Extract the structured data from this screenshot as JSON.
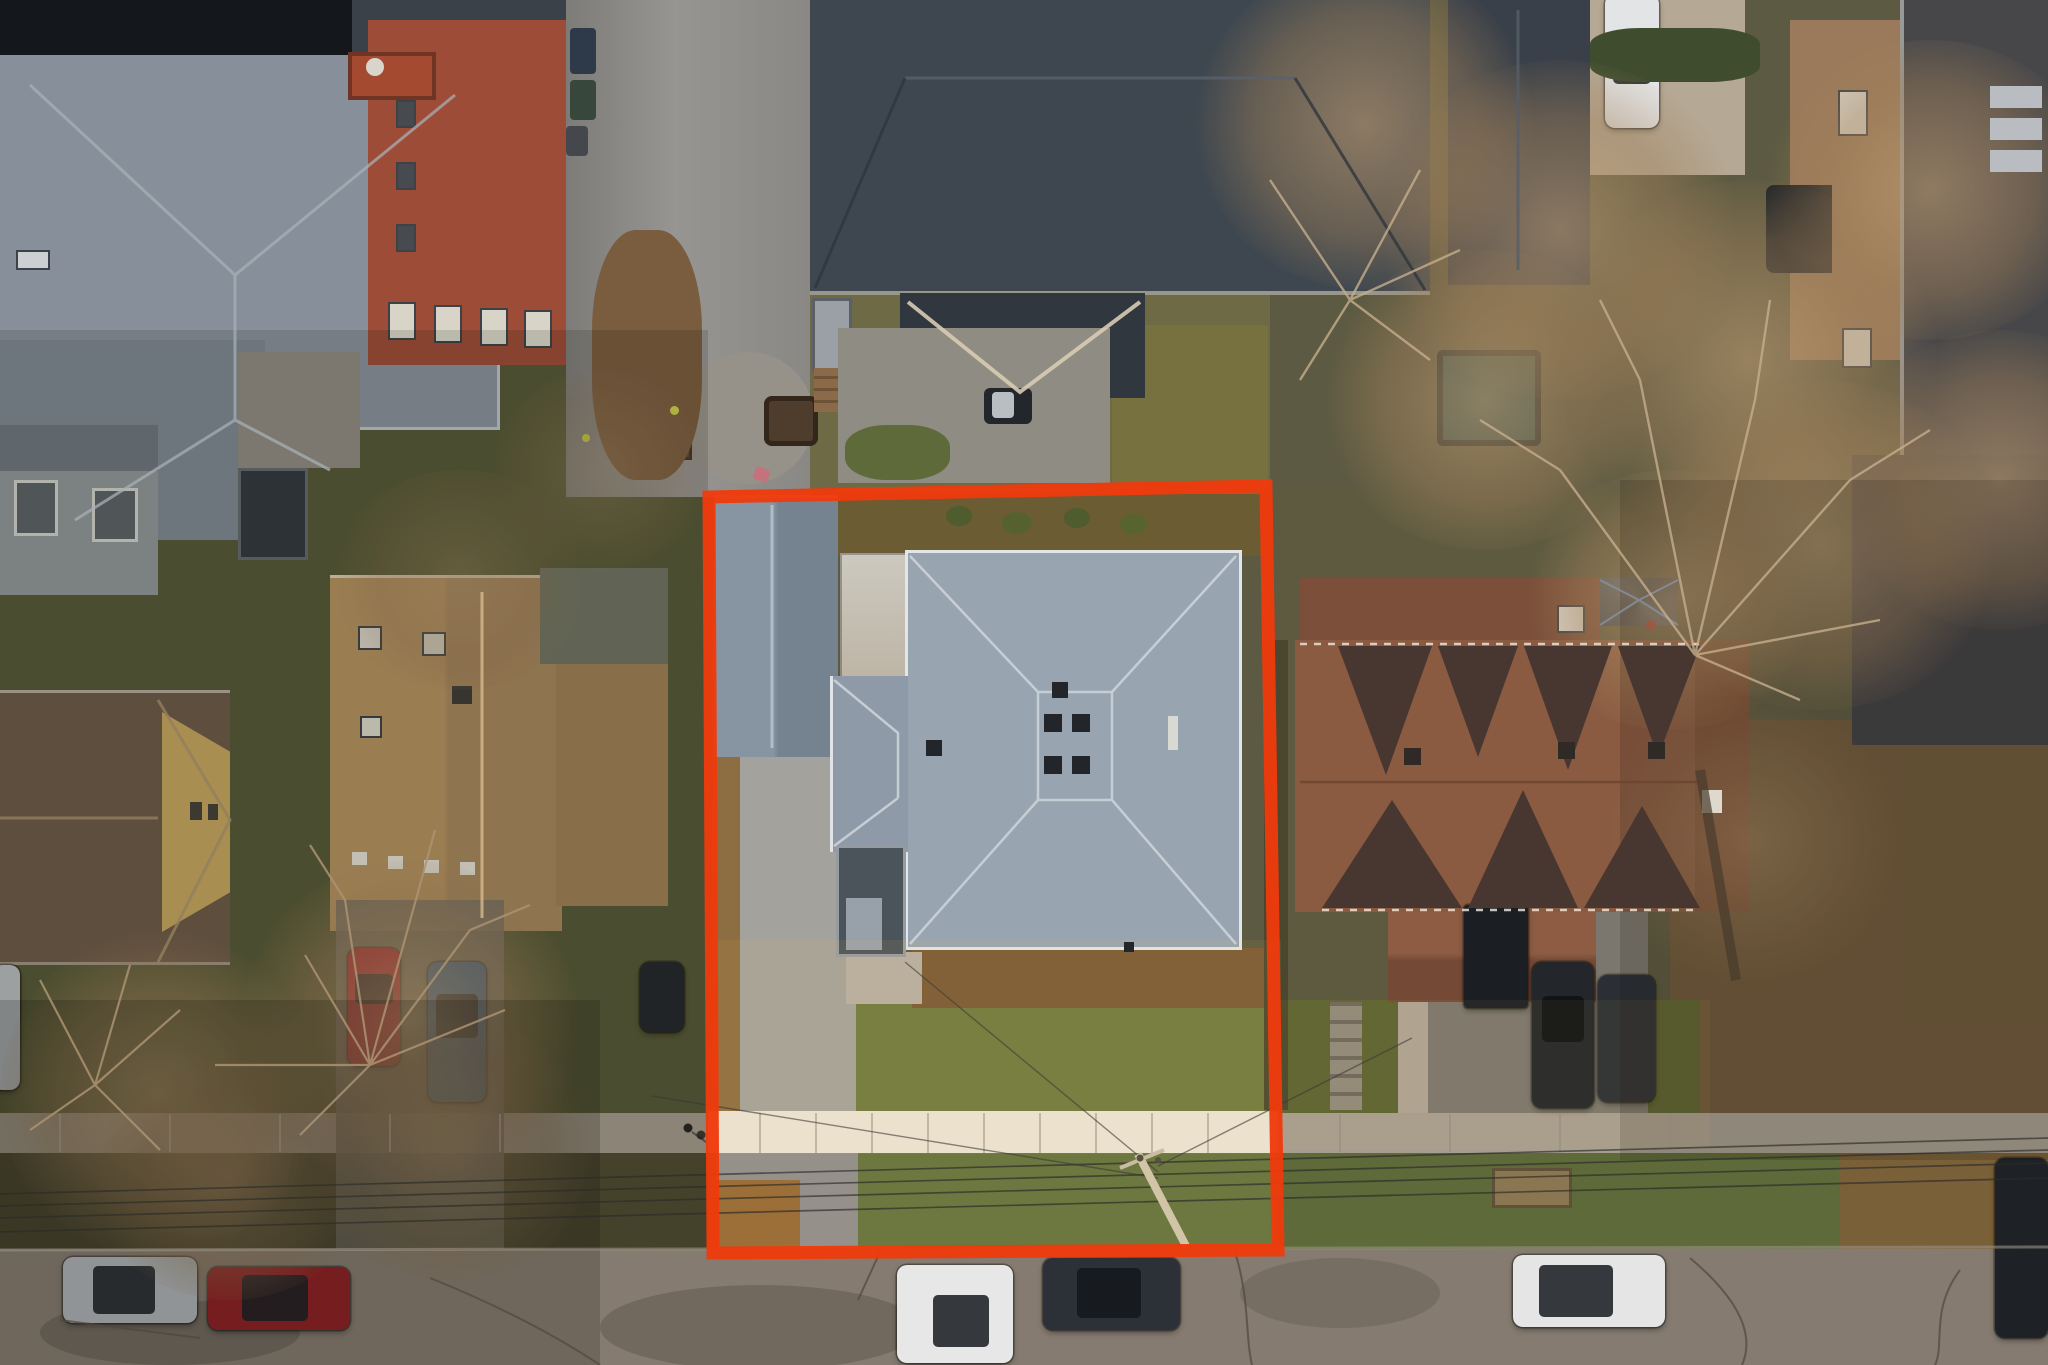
{
  "scene": {
    "type": "aerial-drone-photograph",
    "view": "top-down (nadir) view of a residential block",
    "season": "late-autumn, bare trees, fallen leaves",
    "lighting": "overcast dusk, muted tones, shadowed west side",
    "subject": "single lot highlighted by a rectangular property-boundary overlay",
    "annotation": {
      "shape": "slightly-skewed rectangle",
      "color": "#ee3a0c",
      "stroke_width_px": 13,
      "corners_px": [
        [
          709,
          497
        ],
        [
          1266,
          486
        ],
        [
          1278,
          1250
        ],
        [
          713,
          1253
        ]
      ]
    }
  },
  "palette": {
    "boundary_red": "#ee3a0c",
    "main_roof_gray": "#98a4b0",
    "garage_roof_gray": "#8795a3",
    "north_roof_dark": "#3e474f",
    "northwest_roof_gray": "#87909a",
    "brick_red": "#9c4c37",
    "tan_roof": "#b3905f",
    "yellow_siding": "#c2a45c",
    "brown_duplex_roof": "#8a5a41",
    "duplex_valley_dark": "#483730",
    "east_brick_tan": "#9a7a5a",
    "lawn_green": "#6e7a40",
    "dry_lawn_olive": "#565837",
    "street_asphalt": "#857b70",
    "sidewalk_bright": "#eae4d6",
    "sidewalk_dim": "#a69d90",
    "driveway_concrete": "#a4a29c",
    "tree_canopy_tan": "#b59677"
  },
  "objects": [
    {
      "name": "property-outline",
      "color": "#ee3a0c"
    },
    {
      "name": "lot-main-house-hip-roof",
      "color": "#98a4b0"
    },
    {
      "name": "lot-garage-roof",
      "color": "#8795a3"
    },
    {
      "name": "lot-concrete-pad",
      "color": "#ccc9c0"
    },
    {
      "name": "lot-dark-side-annex",
      "color": "#4b535b"
    },
    {
      "name": "lot-driveway",
      "color": "#a4a29c"
    },
    {
      "name": "lot-front-lawn",
      "color": "#6e7a40"
    },
    {
      "name": "lot-rear-garden-strip",
      "color": "#6b5c33"
    },
    {
      "name": "north-house-dark-roof",
      "color": "#3e474f"
    },
    {
      "name": "north-porch-roof",
      "color": "#30373e"
    },
    {
      "name": "alley-asphalt",
      "color": "#888682"
    },
    {
      "name": "rear-paver-patio",
      "color": "#8f8c84"
    },
    {
      "name": "fire-pit-chair",
      "color": "#4e3c2c"
    },
    {
      "name": "bbq-grill",
      "color": "#23272b"
    },
    {
      "name": "brick-rowhouse",
      "color": "#9c4c37"
    },
    {
      "name": "northwest-gray-roof",
      "color": "#87909a"
    },
    {
      "name": "northwest-flat-roof",
      "color": "#14171c"
    },
    {
      "name": "west-small-gray-house",
      "color": "#8e9697"
    },
    {
      "name": "west-storage-shed",
      "color": "#32383d"
    },
    {
      "name": "west-glass-pergola",
      "color": "#262b30"
    },
    {
      "name": "west-tan-house-roof",
      "color": "#b3905f"
    },
    {
      "name": "west-yellow-house",
      "color": "#c2a45c"
    },
    {
      "name": "west-overgrown-yard",
      "color": "#565837"
    },
    {
      "name": "east-brown-duplex-roof",
      "color": "#8a5a41"
    },
    {
      "name": "east-duplex-porch-roof",
      "color": "#744a36"
    },
    {
      "name": "east-gazebo-pyramid-roof",
      "color": "#4c5660"
    },
    {
      "name": "east-tan-brick-house",
      "color": "#9a7a5a"
    },
    {
      "name": "east-dark-roof-house",
      "color": "#474749"
    },
    {
      "name": "rear-dark-gable-house",
      "color": "#394049"
    },
    {
      "name": "teal-tarp-structure",
      "color": "#39544e"
    },
    {
      "name": "utility-pole",
      "color": "#d2c5a7"
    },
    {
      "name": "power-lines",
      "color": "#2b2b28"
    },
    {
      "name": "sidewalk-bright-segment",
      "color": "#eae4d6"
    },
    {
      "name": "sidewalk",
      "color": "#a69d90"
    },
    {
      "name": "street",
      "color": "#857b70"
    },
    {
      "name": "street-car-silver",
      "color": "#aeb3b6"
    },
    {
      "name": "street-car-red",
      "color": "#8e2125"
    },
    {
      "name": "street-car-white",
      "color": "#e6e7e6"
    },
    {
      "name": "street-car-dark",
      "color": "#2c3137"
    },
    {
      "name": "street-suv-white-east",
      "color": "#e4e5e4"
    },
    {
      "name": "corner-suv-dark",
      "color": "#1e2227"
    },
    {
      "name": "west-driveway-car-red",
      "color": "#a3262e"
    },
    {
      "name": "west-driveway-car-blue",
      "color": "#3b5e80"
    },
    {
      "name": "west-driveway-car-dark",
      "color": "#24282d"
    },
    {
      "name": "east-driveway-truck-black",
      "color": "#1b1f24"
    },
    {
      "name": "east-driveway-suv-black",
      "color": "#23272c"
    },
    {
      "name": "east-driveway-car-dark",
      "color": "#2b2f35"
    },
    {
      "name": "north-white-car",
      "color": "#e3e4e5"
    },
    {
      "name": "pedestrians-on-sidewalk",
      "color": "#23211e"
    },
    {
      "name": "bare-trees",
      "color": "#b59677"
    }
  ]
}
